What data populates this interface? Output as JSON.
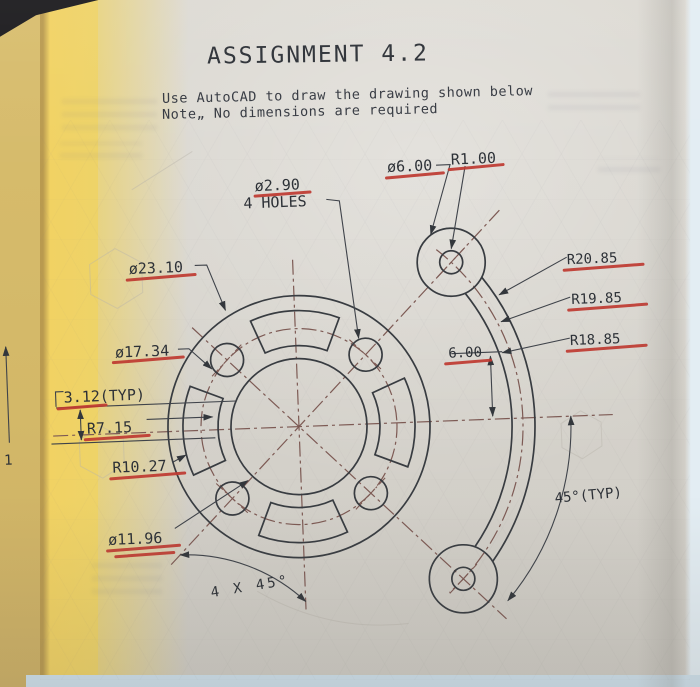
{
  "page": {
    "title": "ASSIGNMENT 4.2",
    "instr1": "Use AutoCAD to draw the drawing shown below",
    "instr2": "Note„ No dimensions are required",
    "left_fragment": "1"
  },
  "dwg": {
    "hole_dia": "ø2.90",
    "hole_count": "4 HOLES",
    "top_slot_dia": "ø6.00",
    "top_slot_rad": "R1.00",
    "outer_dia": "ø23.10",
    "bolt_dia": "ø17.34",
    "pad_thk": "3.12(TYP)",
    "pad_inner": "R7.15",
    "pad_outer": "R10.27",
    "bore_dia": "ø11.96",
    "arm_outer": "R20.85",
    "arm_mid": "R19.85",
    "arm_inner": "R18.85",
    "arm_width": "6.00",
    "end_angle": "45°(TYP)",
    "pad_angle": "4 X 45°"
  },
  "colors": {
    "paper": "#d6d3cc",
    "object_line": "#383c41",
    "centerline": "#7d5a54",
    "marker_underline": "#bf3a31",
    "page_edge_yellow": "#f1d263",
    "table_blue": "#cfe1ec"
  }
}
